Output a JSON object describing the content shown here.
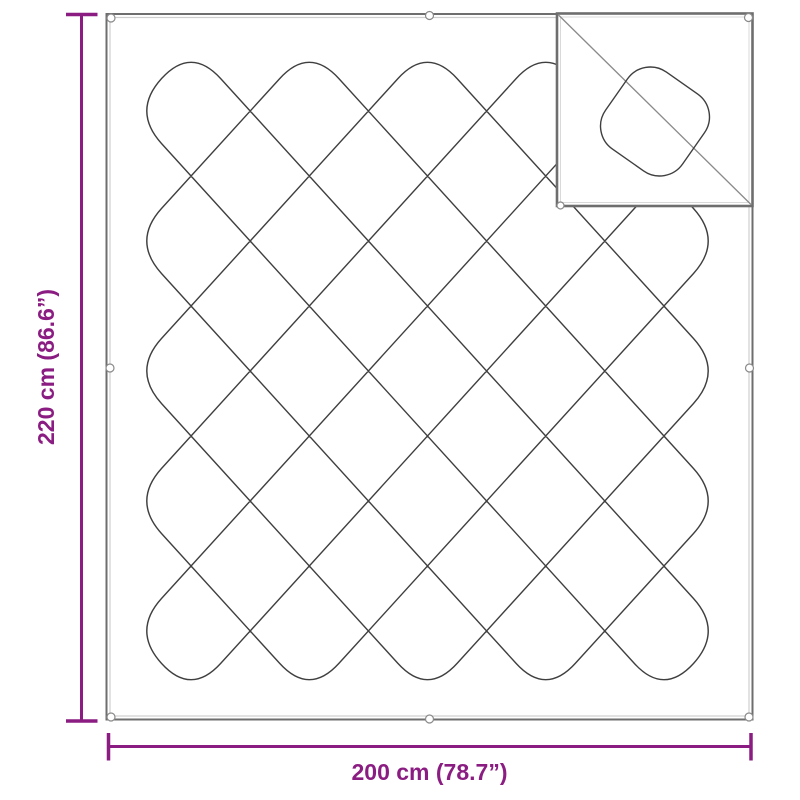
{
  "diagram": {
    "title": "blanket-dimension-diagram",
    "background": "#ffffff"
  },
  "dimensions": {
    "height_label": "220 cm (86.6”)",
    "width_label": "200 cm (78.7”)"
  },
  "colors": {
    "accent": "#8b1d82",
    "pattern_line": "#3f3f3f",
    "border": "#6e6e6e",
    "border_inner": "#cfcfcf",
    "inset_diagonal": "#8a8a8a",
    "grommet": "#8a8a8a"
  },
  "pattern": {
    "style": "diamond-quilt-lattice",
    "rows": 5,
    "cols": 5
  },
  "grommets": {
    "count": 8
  },
  "inset": {
    "content": "stitch-detail-close-up"
  }
}
